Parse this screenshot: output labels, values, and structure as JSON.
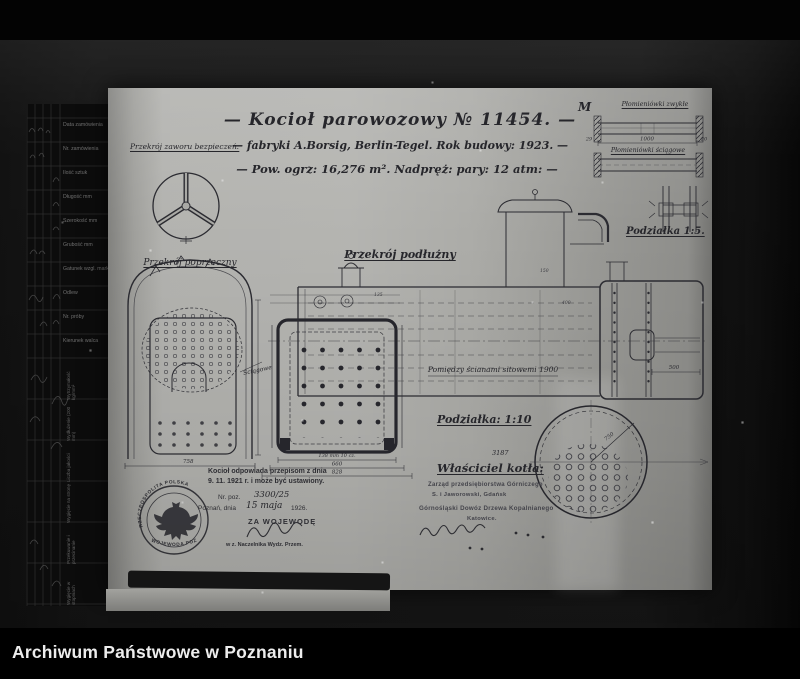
{
  "page": {
    "caption": "Archiwum Państwowe w Poznaniu"
  },
  "title": {
    "line1": "— Kocioł parowozowy  № 11454. —",
    "line2": "— fabryki A.Borsig, Berlin-Tegel.  Rok budowy: 1923. —",
    "line3": "— Pow. ogrz: 16,276 m².   Nadpręż: pary: 12 atm: —"
  },
  "labels": {
    "safety_valve_section": "Przekrój zaworu bezpieczeń:",
    "cross_section": "Przekrój poprzeczny",
    "longitudinal_section": "Przekrój podłużny",
    "between_tube_plates": "Pomiędzy ścianami sitowemi 1900",
    "stay_tubes": "Ściągowe",
    "scale_1_10": "Podziałka: 1:10",
    "scale_1_5": "Podziałka 1:5.",
    "boiler_owner": "Właściciel kotła:",
    "registry_number": "3187",
    "corner_mark": "M",
    "fire_tubes_plain": "Płomieniówki zwykłe",
    "fire_tubes_stay": "Płomieniówki ściągowe"
  },
  "dimensions": {
    "cross_section_width": "758",
    "grate_row_spacing": "138 mm 10 cz.",
    "grate_inner_width": "660",
    "grate_outer_width": "828",
    "tube_length": "1000",
    "tube_end_left": "29",
    "tube_end_right": "20",
    "end_view_radius": "750",
    "smokebox_depth": "500",
    "dome_note": "150",
    "barrel_note": "400",
    "firebox_note": "135"
  },
  "certification": {
    "line1": "Kocioł odpowiada przepisom z dnia",
    "line2": "9. 11. 1921 r. i może być ustawiony.",
    "position_label": "Nr. poz.",
    "position_value": "3300/25",
    "place_date_prefix": "Poznań, dnia",
    "date_handwritten": "15 maja",
    "year": "1926.",
    "signed_for": "ZA WOJEWODĘ",
    "undersigned_note": "w z. Naczelnika Wydz. Przem.",
    "stamp_text_top": "RZECZPOSPOLITA POLSKA",
    "stamp_text_bottom": "WOJEWODA POZNAŃSKI"
  },
  "owner_stamp": {
    "line1": "Zarząd przedsiębiorstwa Górniczego",
    "line2": "S. i Jaworowski, Gdańsk",
    "line3": "Górnośląski Dowóz Drzewa Kopalnianego",
    "line4": "Katowice."
  },
  "side_table": {
    "rows": [
      "Data zamówienia",
      "Nr. zamówienia",
      "Ilość sztuk",
      "Długość mm",
      "Szerokość mm",
      "Grubość mm",
      "Gatunek wzgl. marka",
      "Odlew",
      "Nr. próby",
      "Kierunek walca"
    ],
    "rotated_rows": [
      "Wytrzymałość kg/mm²",
      "Wydłużenie (200 mm)",
      "Liczba jakości",
      "Wygięcie na stronę",
      "Przekuwanie i przecinanie",
      "Wygięcie w stopniach"
    ]
  },
  "colors": {
    "paper": "#a9a9a5",
    "ink": "#2b2b31",
    "photo_bg": "#161616"
  }
}
